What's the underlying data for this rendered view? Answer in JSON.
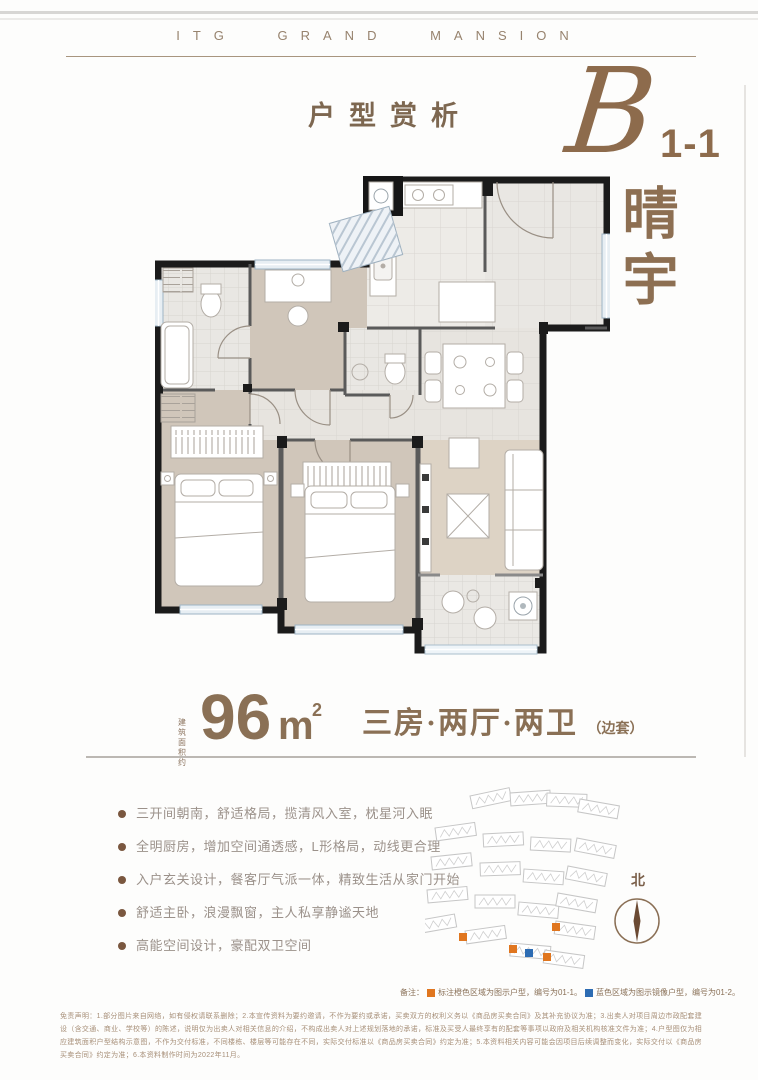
{
  "brand": {
    "logo_text": "ITG GRAND MANSION"
  },
  "header": {
    "section_title": "户型赏析"
  },
  "unit": {
    "letter": "B",
    "number": "1-1",
    "name_char_1": "晴",
    "name_char_2": "宇",
    "accent_color": "#8d6b4c"
  },
  "area": {
    "prefix_line1": "建筑",
    "prefix_line2": "面积约",
    "value": "96",
    "unit": "m",
    "sup": "2",
    "layout": "三房·两厅·两卫",
    "layout_suffix": "（边套）"
  },
  "features": [
    "三开间朝南，舒适格局，揽清风入室，枕星河入眠",
    "全明厨房，增加空间通透感，L形格局，动线更合理",
    "入户玄关设计，餐客厅气派一体，精致生活从家门开始",
    "舒适主卧，浪漫飘窗，主人私享静谧天地",
    "高能空间设计，豪配双卫空间"
  ],
  "siteplan": {
    "north_label": "北",
    "highlight_orange": "#e0761f",
    "highlight_blue": "#2d6cb3"
  },
  "note": {
    "label": "备注：",
    "orange_text": "标注橙色区域为图示户型，编号为01-1。",
    "blue_text": "蓝色区域为图示镜像户型，编号为01-2。"
  },
  "disclaimer": "免责声明：1.部分图片来自网络，如有侵权请联系删除；2.本宣传资料为要约邀请，不作为要约或承诺，买卖双方的权利义务以《商品房买卖合同》及其补充协议为准；3.出卖人对项目周边市政配套建设（含交通、商业、学校等）的陈述，说明仅为出卖人对相关信息的介绍，不构成出卖人对上述规划落地的承诺，标准及买受人最终享有的配套等事项以政府及相关机构核准文件为准；4.户型图仅为相应建筑面积户型结构示意图，不作为交付标准，不同楼栋、楼层等可能存在不同，实际交付标准以《商品房买卖合同》约定为准；5.本资料相关内容可能会因项目后续调整而变化，实际交付以《商品房买卖合同》约定为准；6.本资料制作时间为2022年11月。"
}
